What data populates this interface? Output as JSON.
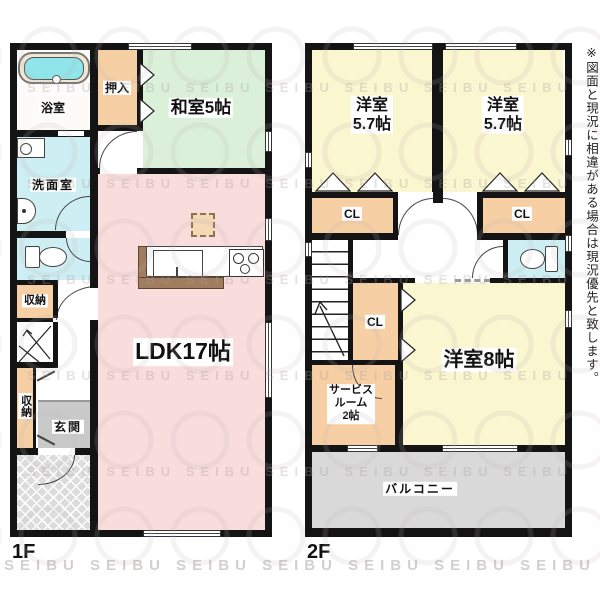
{
  "watermark": {
    "text": "SEIBU",
    "row": "SEIBU SEIBU SEIBU SEIBU SEIBU SEIBU SEIBU"
  },
  "disclaimer": "※図面と現況に相違がある場合は現況優先と致します。",
  "floor1": {
    "label": "1F",
    "rooms": {
      "bath": "浴室",
      "oshiire": "押入",
      "washitsu": "和室5帖",
      "senmen": "洗面室",
      "storage_a": "収納",
      "storage_b": "収納",
      "genkan": "玄関",
      "ldk": "LDK17帖"
    }
  },
  "floor2": {
    "label": "2F",
    "rooms": {
      "bedroom_a": {
        "line1": "洋室",
        "line2": "5.7帖"
      },
      "bedroom_b": {
        "line1": "洋室",
        "line2": "5.7帖"
      },
      "cl_a": "CL",
      "cl_b": "CL",
      "cl_mid": "CL",
      "bedroom_c": "洋室8帖",
      "service": {
        "line1": "サービス",
        "line2": "ルーム",
        "line3": "2帖"
      },
      "balcony": "バルコニー"
    }
  }
}
